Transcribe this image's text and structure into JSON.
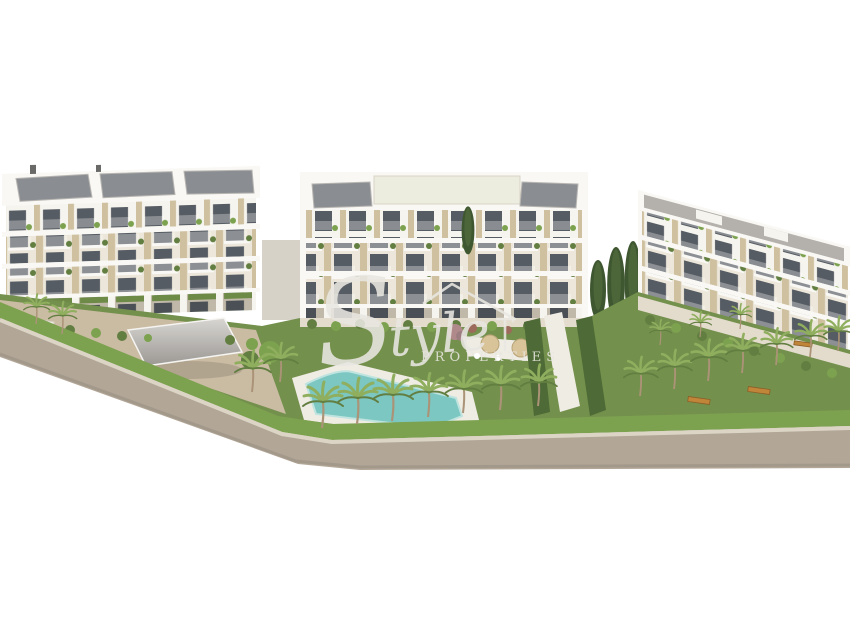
{
  "image": {
    "kind": "architectural-render",
    "description": "3D exterior render of a new-build residential complex: three white apartment blocks with solar panels, landscaped gardens, palm trees, communal swimming pool, carport and perimeter road on a white background",
    "building_count": 3,
    "floors_per_building": 4
  },
  "watermark": {
    "script_initial": "S",
    "script_rest": "tyle",
    "sub_text": "PROPERTIES",
    "icon": "house-roof-icon",
    "color": "#e9e7e1"
  },
  "palette": {
    "bg": "#ffffff",
    "facade": "#ece7da",
    "facade_light": "#f6f4ee",
    "slab": "#f9f8f4",
    "pier": "#cfc0a0",
    "window": "#565c63",
    "window_dark": "#4a5055",
    "roof": "#b4b0ab",
    "panel": "#8a8e93",
    "panel_frame": "#b9b6b2",
    "lawn": "#74904d",
    "lawn_dark": "#627e41",
    "hedge": "#7ca24f",
    "hedge_wall": "#4e6a36",
    "cypress": "#3f5731",
    "palm_frond": "#8fae5e",
    "palm_trunk": "#ab9377",
    "pool": "#7cc7c2",
    "pool_deep": "#4fa8a5",
    "deck": "#efece4",
    "path": "#e3dccd",
    "ground_tan": "#cabba3",
    "road": "#b2a697",
    "curb": "#dcd5c6",
    "road_shadow": "#988e81",
    "bench": "#c08538",
    "parasol": "#d9c49a",
    "blossom": "#b08a8a",
    "watermark": "#e9e7e1"
  }
}
